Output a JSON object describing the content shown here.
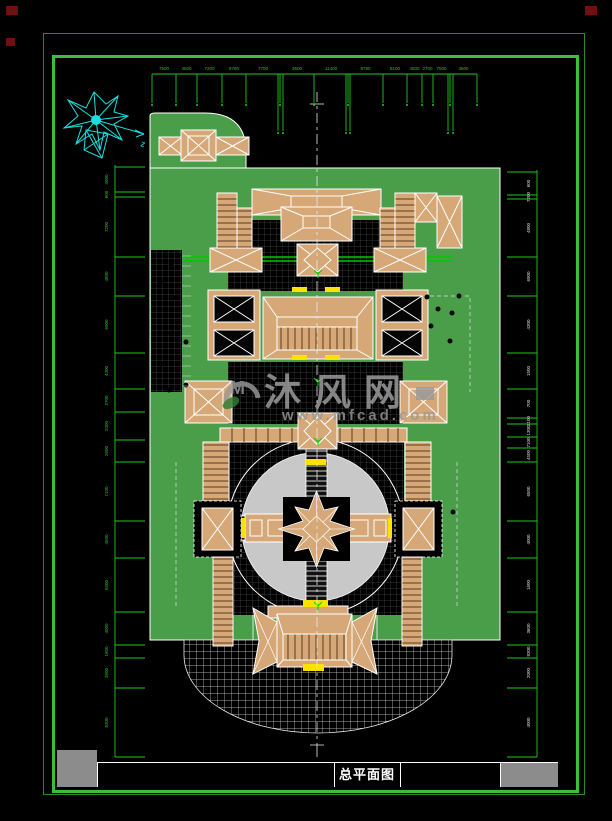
{
  "page": {
    "background": "#000000"
  },
  "title_block": {
    "title": "总平面图"
  },
  "watermark": {
    "site_name": "沐风网",
    "url": "www.mfcad.com",
    "logo": "mufeng-leaf-logo"
  },
  "colors": {
    "frame_outer": "#288c28",
    "frame_inner": "#3cbe3c",
    "grass": "#4a9e4a",
    "building_tan": "#d6a878",
    "plaza_gray": "#c8c8c8",
    "hatch_black": "#000000",
    "dimension_green": "#1ec81e",
    "accent_yellow": "#ffe100",
    "road_green": "#00c800",
    "axis_white": "#e8e8e8",
    "compass_cyan": "#17e0e0",
    "corner_red": "#701010",
    "watermark_gray": "#9a9a9a"
  },
  "dimensions": {
    "top": {
      "labels": [
        "7500",
        "4500",
        "7200",
        "9780",
        "7700",
        "3600",
        "11400",
        "9780",
        "8100",
        "4500",
        "2700",
        "7500",
        "3600"
      ]
    },
    "left": {
      "labels": [
        "3000",
        "600",
        "7200",
        "4800",
        "6900",
        "4300",
        "2700",
        "3400",
        "2600",
        "7100",
        "4500",
        "6500",
        "4000",
        "1600",
        "3600",
        "8300"
      ]
    },
    "right": {
      "labels": [
        "600",
        "7200",
        "4800",
        "6900",
        "4300",
        "1500",
        "700",
        "2100",
        "1300",
        "7100",
        "4500",
        "6500",
        "4000",
        "1600",
        "3600",
        "8300",
        "2000",
        "4000"
      ]
    }
  },
  "drawing": {
    "top_ticks_x": [
      152,
      176,
      197,
      222,
      246,
      280,
      314,
      348,
      383,
      407,
      422,
      433,
      450,
      477
    ],
    "top_long_pairs": [
      [
        278,
        283
      ],
      [
        346,
        350
      ],
      [
        448,
        453
      ]
    ],
    "left_ticks_y": [
      167,
      192,
      197,
      257,
      296,
      353,
      389,
      412,
      440,
      462,
      521,
      558,
      612,
      645,
      658,
      688,
      757
    ],
    "right_ticks_y": [
      172,
      195,
      199,
      257,
      296,
      353,
      389,
      418,
      424,
      437,
      448,
      462,
      521,
      558,
      612,
      645,
      658,
      688,
      757
    ],
    "trees": [
      [
        171,
        263
      ],
      [
        160,
        282
      ],
      [
        175,
        297
      ],
      [
        166,
        333
      ],
      [
        186,
        342
      ],
      [
        161,
        364
      ],
      [
        186,
        385
      ],
      [
        169,
        390
      ],
      [
        427,
        297
      ],
      [
        438,
        309
      ],
      [
        431,
        326
      ],
      [
        450,
        341
      ],
      [
        459,
        296
      ],
      [
        452,
        313
      ],
      [
        453,
        512
      ]
    ],
    "axis_plants": [
      [
        318,
        272
      ],
      [
        318,
        380
      ],
      [
        318,
        440
      ],
      [
        318,
        604
      ]
    ]
  }
}
